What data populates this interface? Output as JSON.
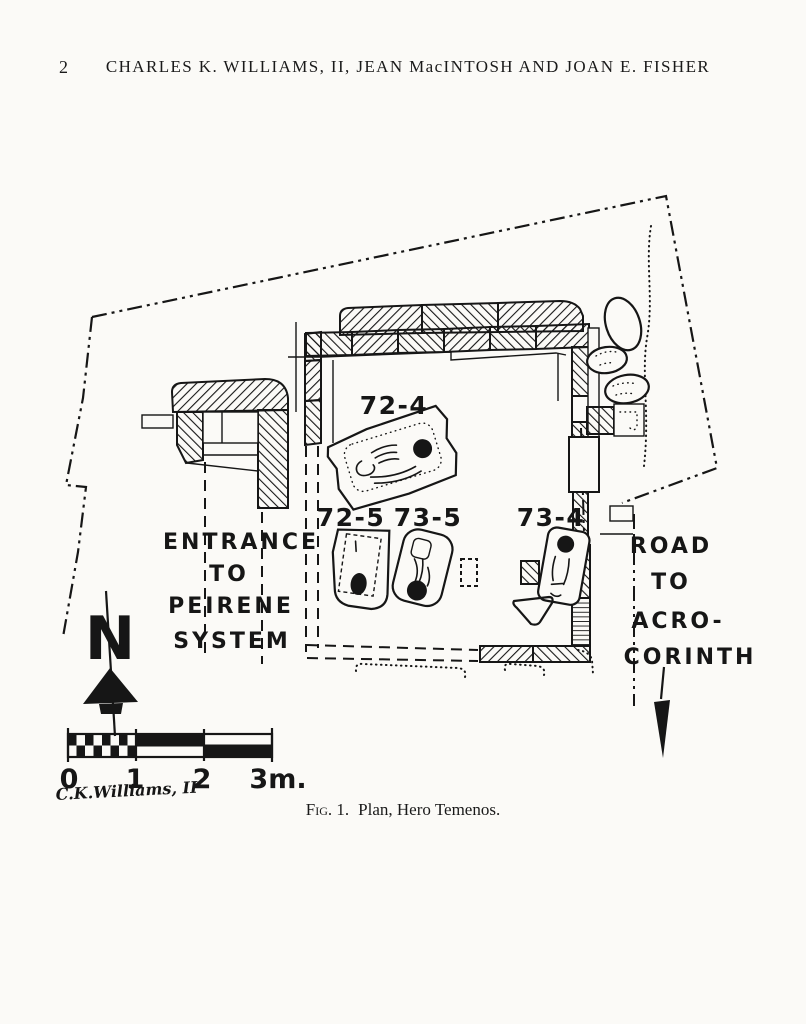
{
  "page": {
    "number": "2",
    "running_head": "CHARLES K. WILLIAMS, II, JEAN MacINTOSH AND JOAN E. FISHER"
  },
  "plan": {
    "graves": {
      "g72_4": "72-4",
      "g72_5": "72-5",
      "g73_5": "73-5",
      "g73_4": "73-4"
    },
    "entrance_label": [
      "ENTRANCE",
      "TO",
      "PEIRENE",
      "SYSTEM"
    ],
    "road_label": [
      "ROAD",
      "TO",
      "ACRO-",
      "CORINTH"
    ],
    "north_letter": "N",
    "scale": {
      "t0": "0",
      "t1": "1",
      "t2": "2",
      "t3": "3m."
    },
    "signature": "C.K.Williams, II"
  },
  "caption": {
    "label": "Fig. 1.",
    "text": "Plan, Hero Temenos."
  },
  "colors": {
    "ink": "#161616",
    "paper": "#fbfaf7"
  }
}
